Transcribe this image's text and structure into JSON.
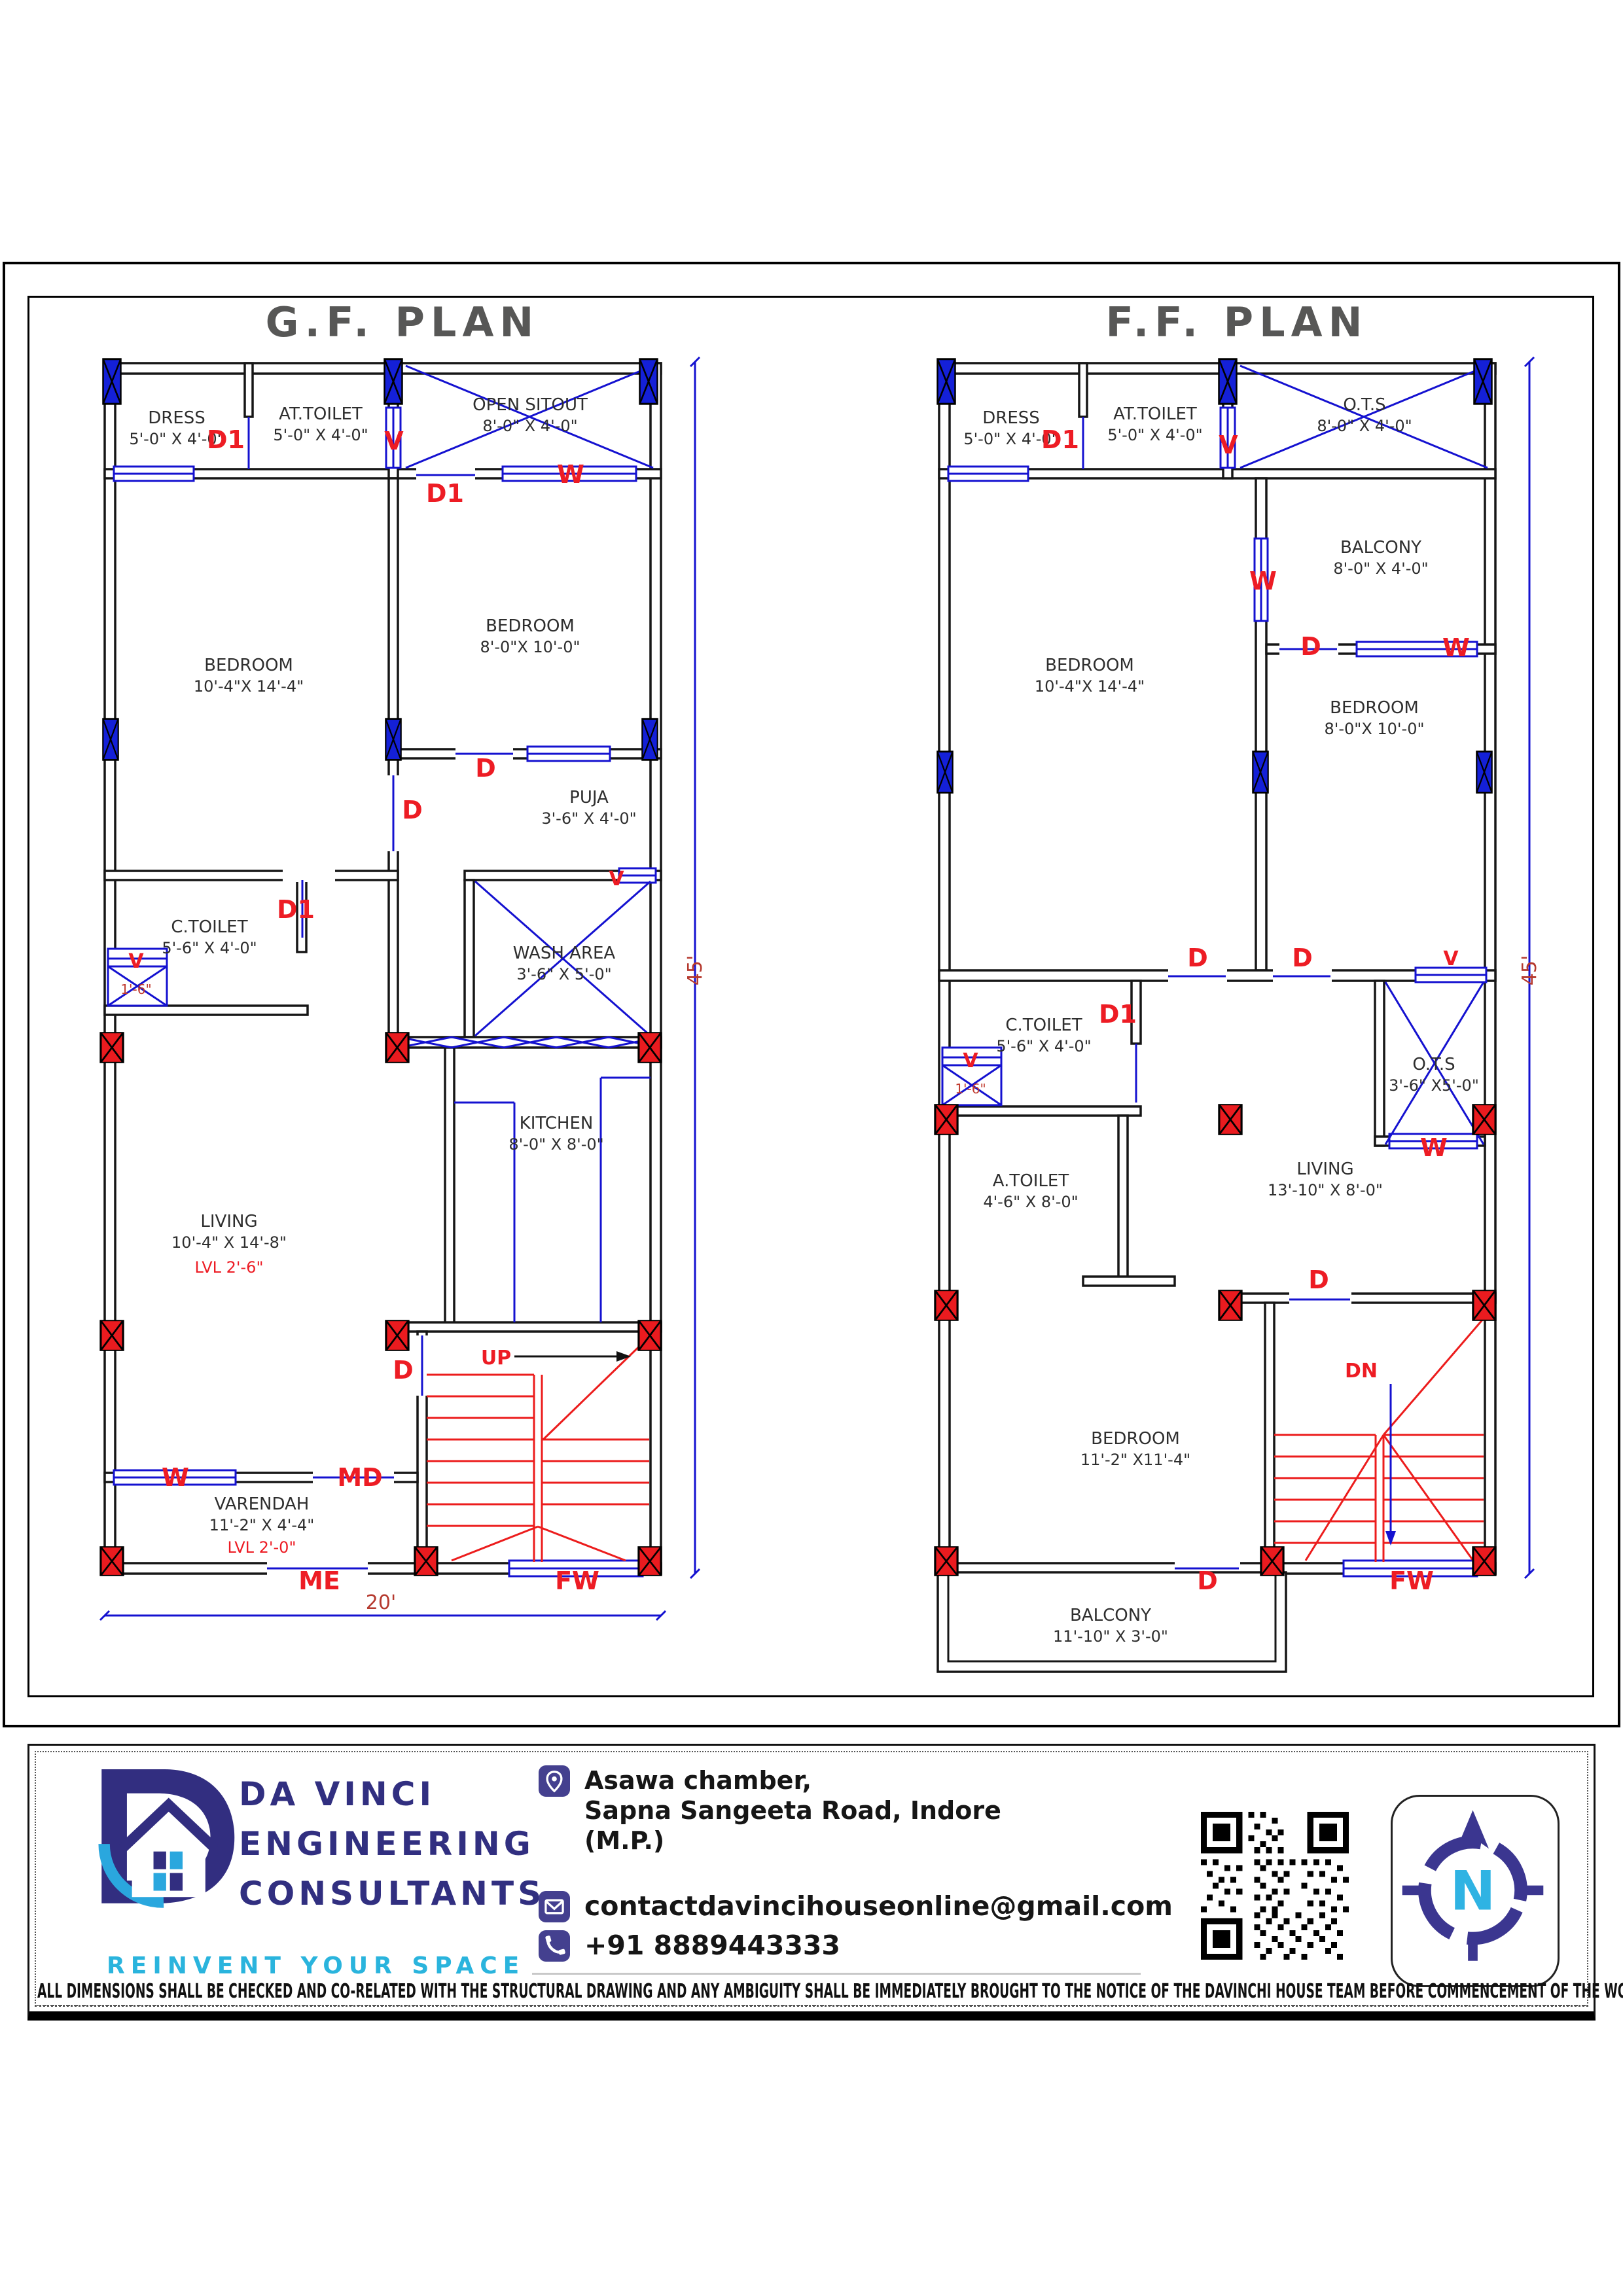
{
  "colors": {
    "wall": "#161616",
    "cad_blue": "#1411d0",
    "cad_red": "#ec1c1c",
    "dim_red": "#b5392e",
    "title_gray": "#575756",
    "brand_navy": "#312f80",
    "brand_cyan": "#2ab4dd",
    "icon_indigo": "#44408f"
  },
  "plans": {
    "gf": {
      "title": "G.F. PLAN",
      "rooms": {
        "dress": [
          "DRESS",
          "5'-0\" X 4'-0\""
        ],
        "at_toilet": [
          "AT.TOILET",
          "5'-0\" X 4'-0\""
        ],
        "open_sitout": [
          "OPEN SITOUT",
          "8'-0\" X 4'-0\""
        ],
        "bedroom_big": [
          "BEDROOM",
          "10'-4\"X 14'-4\""
        ],
        "bedroom_small": [
          "BEDROOM",
          "8'-0\"X 10'-0\""
        ],
        "puja": [
          "PUJA",
          "3'-6\" X 4'-0\""
        ],
        "c_toilet": [
          "C.TOILET",
          "5'-6\" X 4'-0\""
        ],
        "wash_area": [
          "WASH AREA",
          "3'-6\" X 5'-0\""
        ],
        "kitchen": [
          "KITCHEN",
          "8'-0\" X 8'-0\""
        ],
        "living": [
          "LIVING",
          "10'-4\" X 14'-8\"",
          "LVL 2'-6\""
        ],
        "varendah": [
          "VARENDAH",
          "11'-2\" X 4'-4\"",
          "LVL 2'-0\""
        ]
      },
      "tags": {
        "d1_dress": "D1",
        "v_top": "V",
        "d1_pass": "D1",
        "w_pass": "W",
        "d_puja": "D",
        "d_bed": "D",
        "d1_toilet": "D1",
        "v_wash": "V",
        "v_basin": "V",
        "basin_dim": "1'-6\"",
        "w_verandah": "W",
        "md": "MD",
        "me": "ME",
        "fw": "FW",
        "d_stair": "D",
        "up": "UP"
      },
      "dims": {
        "height": "45'",
        "width": "20'"
      }
    },
    "ff": {
      "title": "F.F. PLAN",
      "rooms": {
        "dress": [
          "DRESS",
          "5'-0\" X 4'-0\""
        ],
        "at_toilet": [
          "AT.TOILET",
          "5'-0\" X 4'-0\""
        ],
        "ots_top": [
          "O.T.S",
          "8'-0\" X 4'-0\""
        ],
        "balcony_top": [
          "BALCONY",
          "8'-0\" X 4'-0\""
        ],
        "bedroom_big": [
          "BEDROOM",
          "10'-4\"X 14'-4\""
        ],
        "bedroom_small": [
          "BEDROOM",
          "8'-0\"X 10'-0\""
        ],
        "c_toilet": [
          "C.TOILET",
          "5'-6\" X 4'-0\""
        ],
        "ots_small": [
          "O.T.S",
          "3'-6\" X5'-0\""
        ],
        "a_toilet": [
          "A.TOILET",
          "4'-6\" X 8'-0\""
        ],
        "living": [
          "LIVING",
          "13'-10\" X 8'-0\""
        ],
        "bedroom_rear": [
          "BEDROOM",
          "11'-2\" X11'-4\""
        ],
        "balcony_bottom": [
          "BALCONY",
          "11'-10\" X 3'-0\""
        ]
      },
      "tags": {
        "d1_dress": "D1",
        "v_top": "V",
        "w_mid": "W",
        "d_balc": "D",
        "w_balc": "W",
        "d_left": "D",
        "d_right": "D",
        "v_pass": "V",
        "d1_toilet": "D1",
        "v_basin": "V",
        "basin_dim": "1'-6\"",
        "w_ots": "W",
        "d_living": "D",
        "dn": "DN",
        "d_balc2": "D",
        "fw": "FW"
      },
      "dims": {
        "height": "45'"
      }
    }
  },
  "titleblock": {
    "company_line1": "DA VINCI",
    "company_line2": "ENGINEERING",
    "company_line3": "CONSULTANTS",
    "tagline": "REINVENT YOUR SPACE",
    "address_line1": "Asawa chamber,",
    "address_line2": "Sapna Sangeeta Road, Indore",
    "address_line3": "(M.P.)",
    "email": "contactdavincihouseonline@gmail.com",
    "phone": "+91 8889443333",
    "compass_letter": "N",
    "disclaimer": "ALL DIMENSIONS SHALL BE CHECKED AND CO-RELATED WITH THE STRUCTURAL DRAWING AND ANY AMBIGUITY SHALL BE IMMEDIATELY BROUGHT TO THE NOTICE OF THE DAVINCHI HOUSE TEAM BEFORE COMMENCEMENT OF THE WORK."
  }
}
